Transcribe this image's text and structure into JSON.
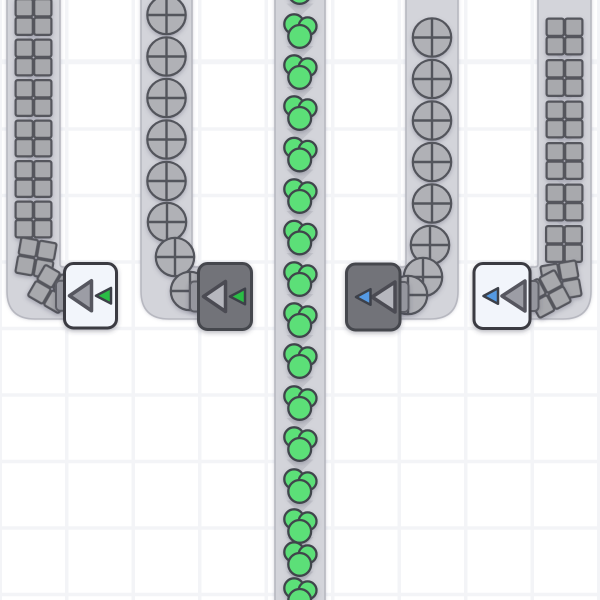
{
  "scene": {
    "width": 600,
    "height": 600,
    "background": {
      "color": "#ffffff",
      "grid_color": "#f3f4f7",
      "grid_size": 66.5,
      "grid_line_width": 3.5,
      "grid_offset_x": -1.5,
      "grid_offset_y": 60.75
    },
    "belt_style": {
      "fill": "#d3d4da",
      "edge": "#b7b8c0",
      "center_arrow_color": "#c3c4cb",
      "side_arrow_color": "#c9cad2"
    },
    "item_styles": {
      "square": {
        "fill": "#a8a9ad",
        "stroke": "#55565d"
      },
      "circle": {
        "fill": "#b0b1b6",
        "stroke": "#53545b"
      },
      "cluster": {
        "fill": "#5bdf78",
        "stroke": "#3f444b"
      }
    },
    "building_styles": {
      "light": {
        "box_fill": "#f2f5fb",
        "box_stroke": "#3a3b43",
        "tri_fill": "#9c9da5",
        "tri_stroke": "#56575f"
      },
      "dark": {
        "box_fill": "#727379",
        "box_stroke": "#45464d",
        "tri_fill": "#b6b7be",
        "tri_stroke": "#4b4c53"
      },
      "nub_fill": "#95969e",
      "nub_stroke": "#5c5d65",
      "small_tri_stroke": "#3e4148",
      "accents": {
        "green": "#2bbd45",
        "blue": "#549ae4"
      }
    },
    "belts": [
      {
        "name": "belt-squares-left",
        "shape": "elbow-right",
        "left": 7,
        "right": 60,
        "top_exit": 267,
        "bottom": 319,
        "corner": 28,
        "exit": 66,
        "item_type": "square",
        "items": [
          {
            "x": 33.5,
            "y": 17
          },
          {
            "x": 33.5,
            "y": 57.5
          },
          {
            "x": 33.5,
            "y": 98
          },
          {
            "x": 33.5,
            "y": 138.5
          },
          {
            "x": 33.5,
            "y": 179
          },
          {
            "x": 33.5,
            "y": 219.5
          },
          {
            "x": 36,
            "y": 258,
            "rot": 10
          },
          {
            "x": 52,
            "y": 289,
            "rot": 30
          }
        ],
        "arrows_y": [
          37.2,
          77.7,
          118.2,
          158.7,
          199.2,
          239.7
        ]
      },
      {
        "name": "belt-circles-left",
        "shape": "elbow-right",
        "left": 141,
        "right": 192,
        "top_exit": 267,
        "bottom": 319,
        "corner": 28,
        "exit": 200,
        "item_type": "circle",
        "items": [
          {
            "x": 166.5,
            "y": 15
          },
          {
            "x": 166.5,
            "y": 56.5
          },
          {
            "x": 166.5,
            "y": 98
          },
          {
            "x": 166.5,
            "y": 139.5
          },
          {
            "x": 166.5,
            "y": 181
          },
          {
            "x": 167,
            "y": 222
          },
          {
            "x": 175,
            "y": 257
          },
          {
            "x": 190,
            "y": 291
          }
        ],
        "arrows_y": [
          35.7,
          77.2,
          118.7,
          160.2,
          201.5
        ]
      },
      {
        "name": "belt-clusters-center",
        "shape": "straight",
        "left": 275,
        "right": 325,
        "item_type": "cluster",
        "items": [
          {
            "x": 300,
            "y": -12
          },
          {
            "x": 300,
            "y": 32
          },
          {
            "x": 300,
            "y": 73
          },
          {
            "x": 300,
            "y": 114
          },
          {
            "x": 300,
            "y": 155.5
          },
          {
            "x": 300,
            "y": 197
          },
          {
            "x": 300,
            "y": 238.5
          },
          {
            "x": 300,
            "y": 280
          },
          {
            "x": 300,
            "y": 321
          },
          {
            "x": 300,
            "y": 362
          },
          {
            "x": 300,
            "y": 404
          },
          {
            "x": 300,
            "y": 445
          },
          {
            "x": 300,
            "y": 487
          },
          {
            "x": 300,
            "y": 527
          },
          {
            "x": 300,
            "y": 560
          },
          {
            "x": 300,
            "y": 596
          }
        ],
        "arrows_y": [
          10,
          52.5,
          93.5,
          135,
          176,
          217.5,
          259.5,
          300.5,
          341.5,
          383,
          424.5,
          466,
          507,
          543.5,
          578
        ]
      },
      {
        "name": "belt-circles-right",
        "shape": "elbow-left",
        "left": 406,
        "right": 458,
        "top_exit": 267,
        "bottom": 319,
        "corner": 28,
        "exit": 399,
        "item_type": "circle",
        "items": [
          {
            "x": 432,
            "y": 37.5
          },
          {
            "x": 432,
            "y": 79
          },
          {
            "x": 432,
            "y": 120.5
          },
          {
            "x": 432,
            "y": 162
          },
          {
            "x": 432,
            "y": 203.5
          },
          {
            "x": 430,
            "y": 245
          },
          {
            "x": 423,
            "y": 277
          },
          {
            "x": 408,
            "y": 295
          }
        ],
        "arrows_y": [
          58.2,
          99.7,
          141.2,
          182.7,
          224
        ]
      },
      {
        "name": "belt-squares-right",
        "shape": "elbow-left",
        "left": 538,
        "right": 591,
        "top_exit": 267,
        "bottom": 319,
        "corner": 28,
        "exit": 531,
        "item_type": "square",
        "items": [
          {
            "x": 564.5,
            "y": 36.5
          },
          {
            "x": 564.5,
            "y": 78
          },
          {
            "x": 564.5,
            "y": 119.5
          },
          {
            "x": 564.5,
            "y": 161
          },
          {
            "x": 564.5,
            "y": 202.5
          },
          {
            "x": 564,
            "y": 244
          },
          {
            "x": 561,
            "y": 281,
            "rot": -10
          },
          {
            "x": 547,
            "y": 294,
            "rot": -28
          }
        ],
        "arrows_y": [
          57.2,
          98.7,
          140.2,
          181.7,
          223.2
        ]
      }
    ],
    "buildings": [
      {
        "name": "machine-green-1",
        "variant": "light",
        "x": 64.5,
        "y": 263.5,
        "w": 52,
        "h": 64.5,
        "input": "left",
        "accent": "green"
      },
      {
        "name": "machine-green-2",
        "variant": "dark",
        "x": 198.5,
        "y": 263.5,
        "w": 53,
        "h": 66,
        "input": "left",
        "accent": "green"
      },
      {
        "name": "machine-blue-1",
        "variant": "dark",
        "x": 346.5,
        "y": 264,
        "w": 53.5,
        "h": 66,
        "input": "right",
        "accent": "blue"
      },
      {
        "name": "machine-blue-2",
        "variant": "light",
        "x": 474,
        "y": 263.5,
        "w": 56,
        "h": 65,
        "input": "right",
        "accent": "blue"
      }
    ]
  }
}
